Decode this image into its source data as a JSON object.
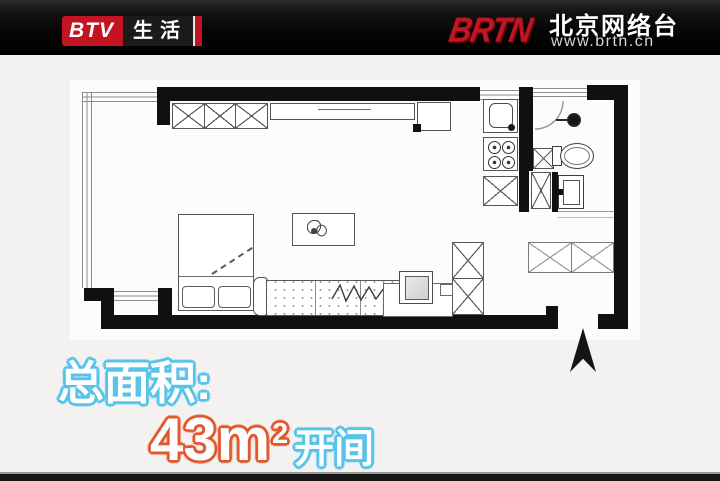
{
  "topbar": {
    "btv_label": "BTV",
    "channel_label": "生活",
    "brtn_label": "BRTN",
    "network_name": "北京网络台",
    "network_url": "www.brtn.cn"
  },
  "caption": {
    "label": "总面积:",
    "value": "43m",
    "exponent": "2",
    "suffix": "开间"
  },
  "colors": {
    "accent_cyan": "#55c3ea",
    "accent_orange": "#e2572c",
    "brand_red": "#c31422",
    "topbar_bg": "#0c0c0c",
    "content_bg": "#f3f2f0",
    "wall": "#101010"
  }
}
